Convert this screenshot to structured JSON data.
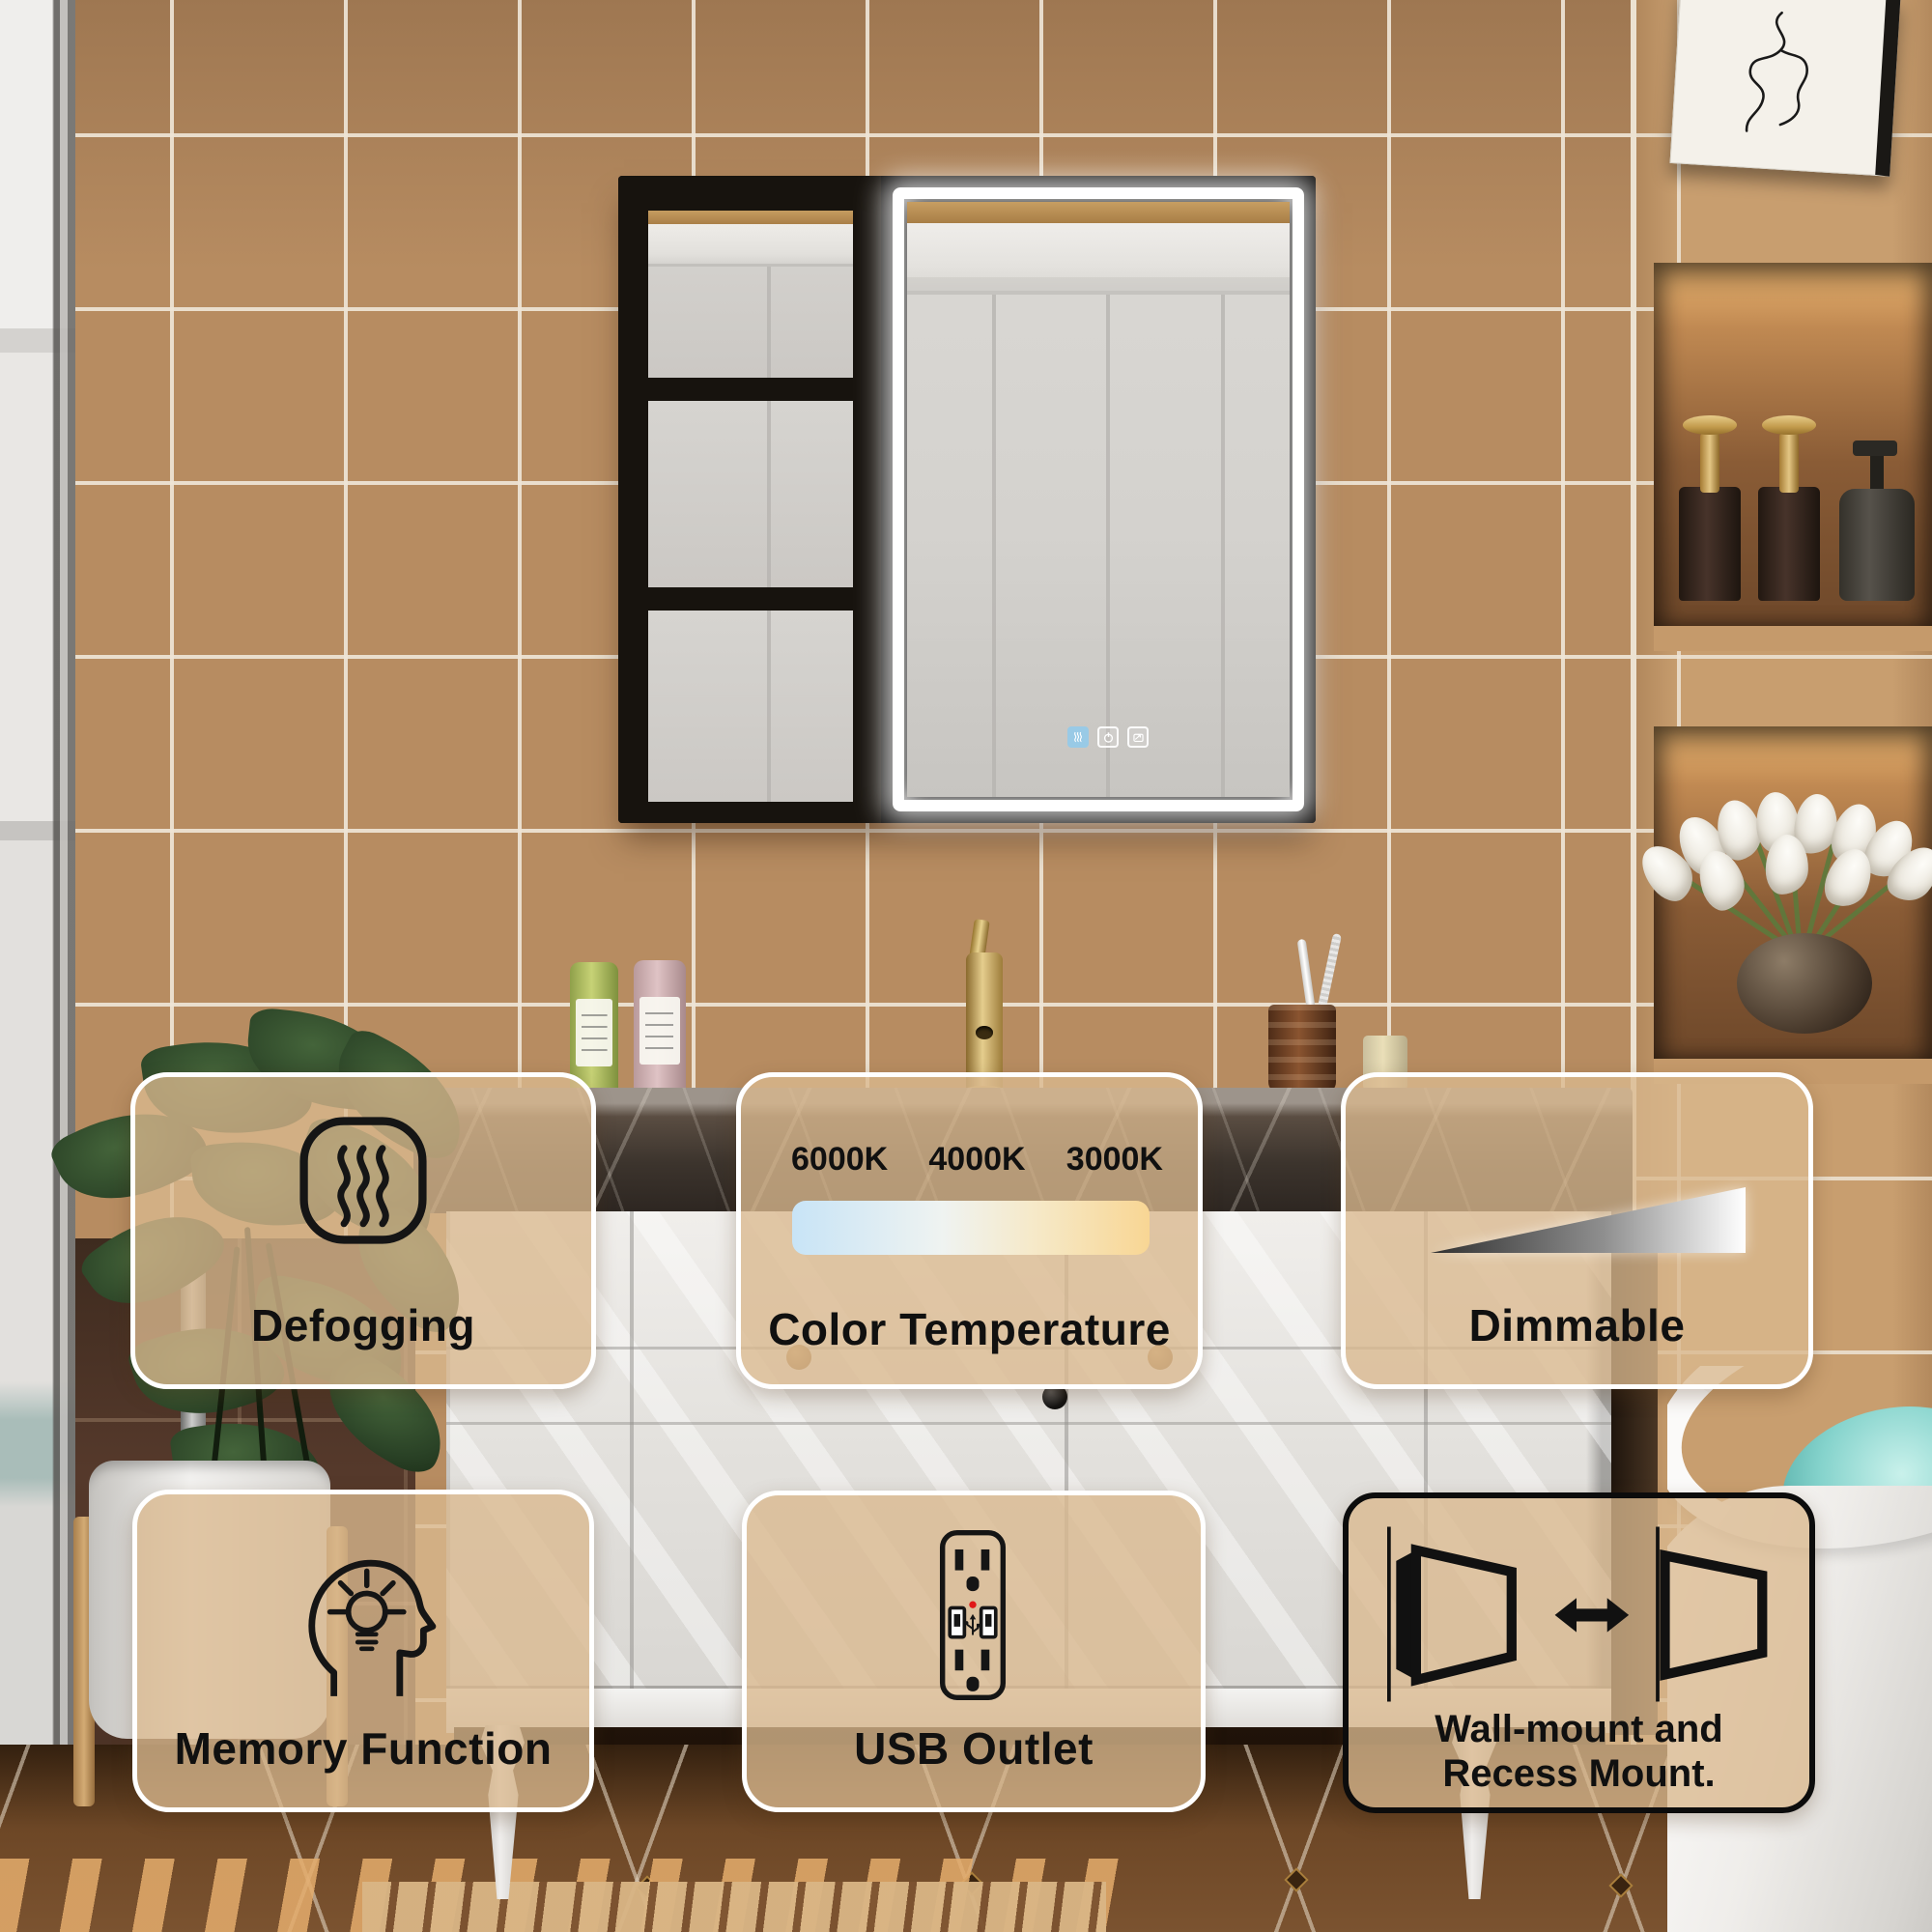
{
  "image_type": "product feature infographic over bathroom photo",
  "product": "LED lighted bathroom medicine cabinet with open shelf",
  "feature_cards": [
    {
      "id": "defogging",
      "icon": "defog-waves-icon",
      "label": "Defogging"
    },
    {
      "id": "color-temperature",
      "icon": "color-temperature-gradient-bar",
      "label": "Color Temperature",
      "temps": [
        "6000K",
        "4000K",
        "3000K"
      ]
    },
    {
      "id": "dimmable",
      "icon": "dimmer-wedge-icon",
      "label": "Dimmable"
    },
    {
      "id": "memory-function",
      "icon": "memory-head-bulb-icon",
      "label": "Memory Function"
    },
    {
      "id": "usb-outlet",
      "icon": "usb-outlet-icon",
      "label": "USB Outlet"
    },
    {
      "id": "mounting",
      "icon": "wall-recess-mount-icon",
      "label_line1": "Wall-mount and",
      "label_line2": "Recess Mount."
    }
  ],
  "mirror_touch_controls": [
    {
      "id": "defog-touch-button",
      "state": "active-blue"
    },
    {
      "id": "power-touch-button",
      "state": "white"
    },
    {
      "id": "antifog-touch-button",
      "state": "white"
    }
  ],
  "colors": {
    "card_background": "rgba(218,184,142,0.78)",
    "card_border_light": "#ffffff",
    "card_border_dark": "#0c0c0c",
    "card_text": "#101010",
    "color_temp_gradient": [
      "#c8e4f6",
      "#eff3f1",
      "#f8d694"
    ],
    "dimmable_gradient": [
      "#303030",
      "#ffffff"
    ],
    "usb_led_dot": "#e01818",
    "defog_button_active": "#96cae8",
    "wall_tile": "#b78c61",
    "led_light": "#ffffff"
  }
}
